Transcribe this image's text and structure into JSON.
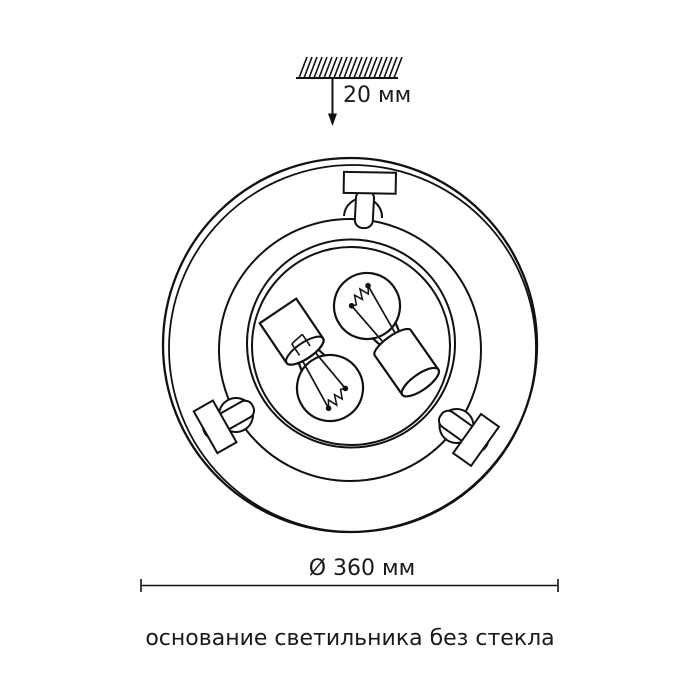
{
  "page": {
    "background_color": "#ffffff",
    "line_color": "#111111",
    "text_color": "#1a1a1a"
  },
  "labels": {
    "mount_height": "20 мм",
    "diameter": "Ø 360 мм",
    "caption": "основание светильника без стекла"
  }
}
